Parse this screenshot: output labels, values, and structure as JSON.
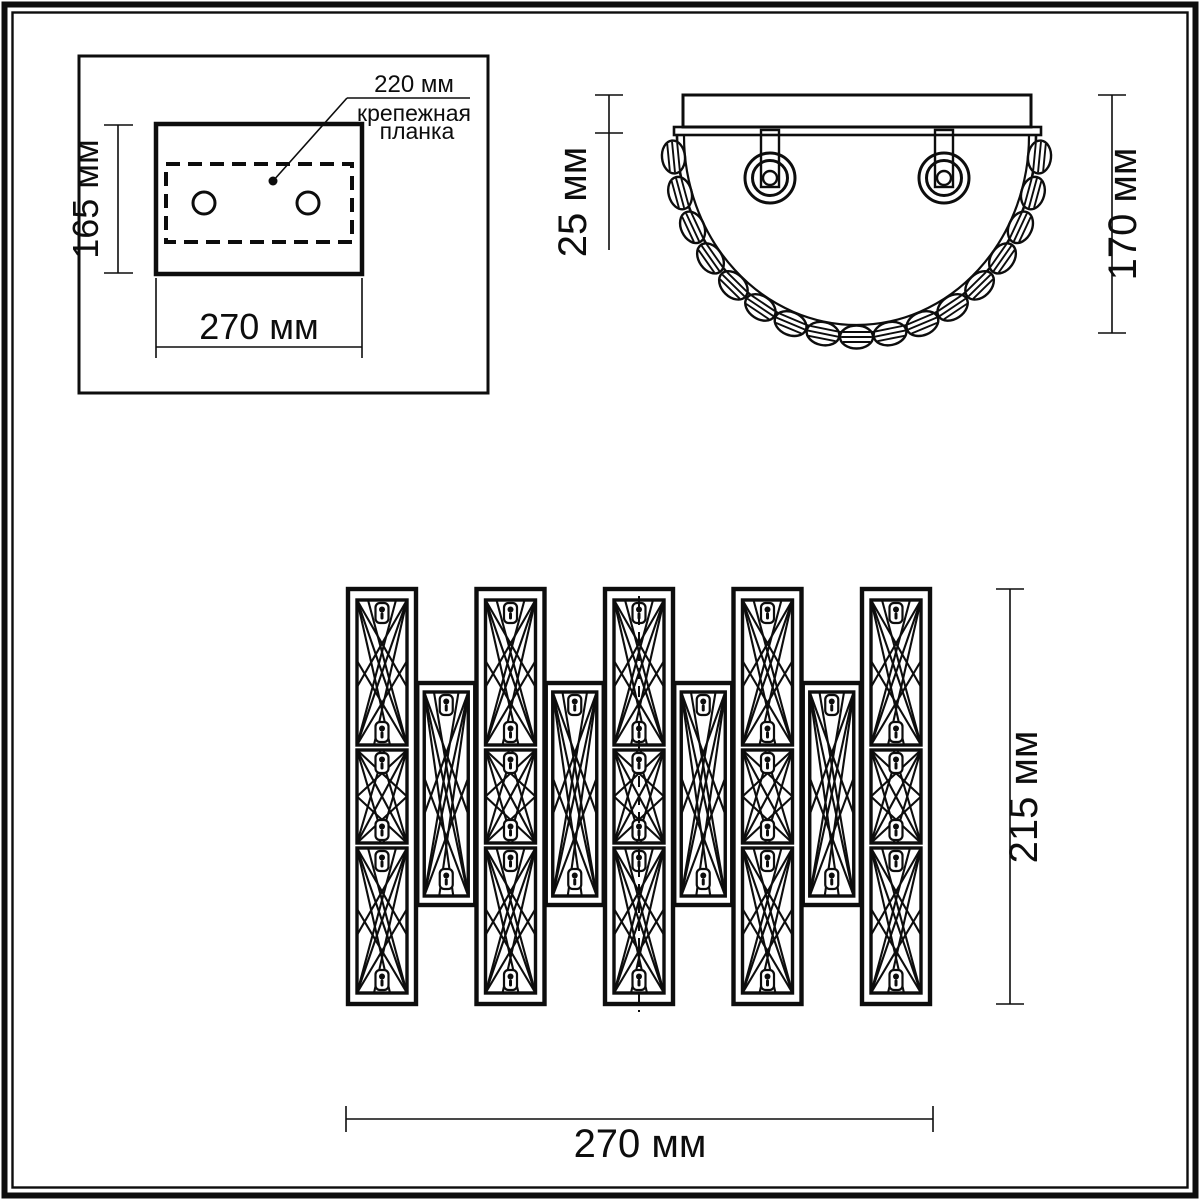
{
  "mount_plate_view": {
    "height": "165 мм",
    "width": "270 мм",
    "bracket_width": "220 мм",
    "bracket_label_line1": "крепежная",
    "bracket_label_line2": "планка"
  },
  "top_view": {
    "plate_thickness": "25 мм",
    "depth": "170 мм"
  },
  "front_view": {
    "height": "215 мм",
    "width": "270 мм"
  }
}
